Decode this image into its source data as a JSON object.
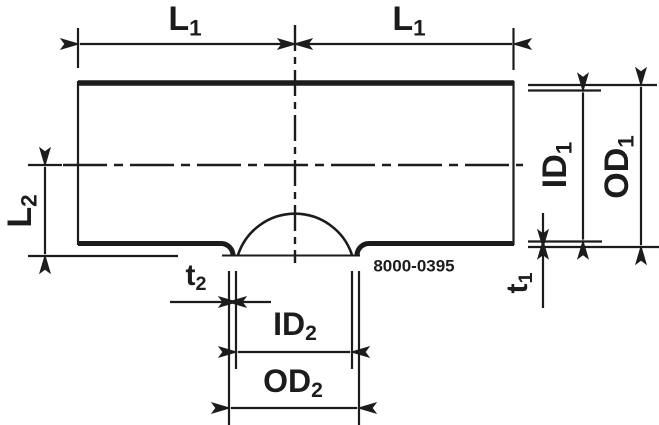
{
  "diagram": {
    "part_number": "8000-0395",
    "colors": {
      "line": "#1c1c1c",
      "background": "#ffffff"
    },
    "labels": {
      "l1_left": {
        "main": "L",
        "sub": "1"
      },
      "l1_right": {
        "main": "L",
        "sub": "1"
      },
      "l2": {
        "main": "L",
        "sub": "2"
      },
      "id1": {
        "main": "ID",
        "sub": "1"
      },
      "od1": {
        "main": "OD",
        "sub": "1"
      },
      "t1": {
        "main": "t",
        "sub": "1"
      },
      "t2": {
        "main": "t",
        "sub": "2"
      },
      "id2": {
        "main": "ID",
        "sub": "2"
      },
      "od2": {
        "main": "OD",
        "sub": "2"
      }
    }
  }
}
